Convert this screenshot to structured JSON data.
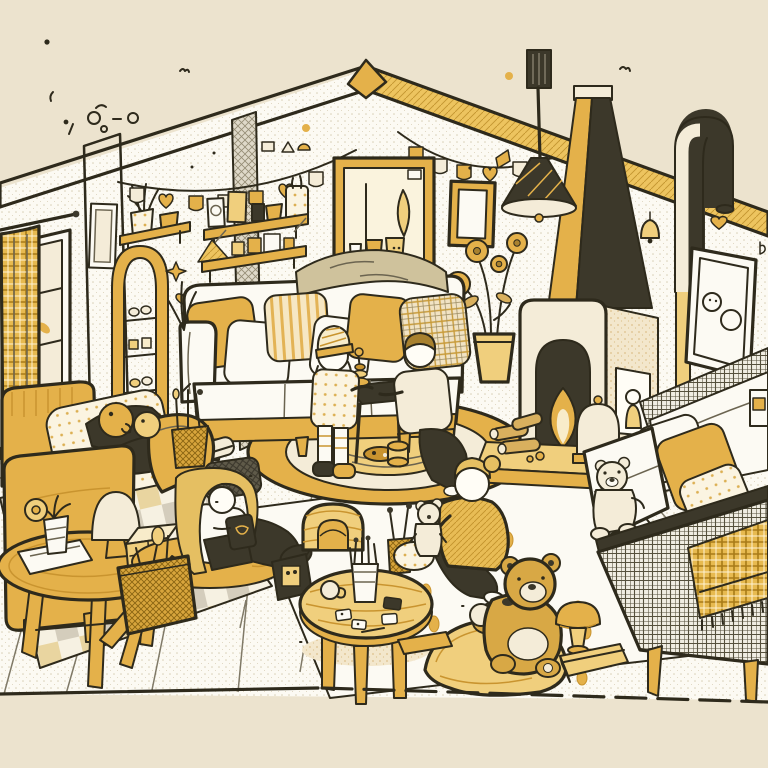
{
  "scene": {
    "description": "Hand-drawn cutaway illustration of a cozy family living room rendered in mustard yellow, cream and black ink line art; gabled back wall, five people, three teddy bears, fireplace with tapered chimney, sofas, rugs and toys.",
    "style": "cartoon line-art, halftone textures, limited mustard/cream palette on beige background",
    "people_count": 5,
    "teddy_bear_count": 3,
    "objects": [
      {
        "id": "roof-fascia",
        "label": "Gabled roof edge with hatched and yellow fascia"
      },
      {
        "id": "bunting-garland-left",
        "label": "Pennant garland on left of back wall"
      },
      {
        "id": "bunting-garland-right",
        "label": "Pennant garland on right of back wall"
      },
      {
        "id": "window",
        "label": "Paned window with yellow plaid curtain"
      },
      {
        "id": "corner-strip",
        "label": "Hatched wall corner strips"
      },
      {
        "id": "small-wall-frame",
        "label": "Small empty frame on left wall"
      },
      {
        "id": "arch-ladder-shelf",
        "label": "Arched ladder shelf with knick-knacks"
      },
      {
        "id": "small-shelf",
        "label": "Small shelf with dried-plant pot and cup"
      },
      {
        "id": "wall-shelves",
        "label": "Two wall shelves with frames, pots and toy blocks"
      },
      {
        "id": "large-wall-art",
        "label": "Large framed botanical artwork with pots"
      },
      {
        "id": "house-wall-art",
        "label": "Small framed house doodle"
      },
      {
        "id": "right-wall-art",
        "label": "Tilted frame with doodle faces and tassel"
      },
      {
        "id": "wall-bell",
        "label": "Small bell on right wall"
      },
      {
        "id": "pendant-lamp",
        "label": "Black cone pendant lamp on rod"
      },
      {
        "id": "fireplace",
        "label": "Fireplace with arched firebox, side niche figurine and tapered chimney"
      },
      {
        "id": "hearth",
        "label": "Hearth platform with logs and pleated dome lantern"
      },
      {
        "id": "chimney-pipe",
        "label": "Curved stove pipe over right wall"
      },
      {
        "id": "flower-pot",
        "label": "Tall potted flowers with round blooms"
      },
      {
        "id": "main-sofa",
        "label": "White sofa with yellow base and five pillows"
      },
      {
        "id": "throw-blanket",
        "label": "Khaki blanket over sofa back"
      },
      {
        "id": "round-rug",
        "label": "Round yellow rug with concentric rings"
      },
      {
        "id": "play-table",
        "label": "Dark play table with stacking-ring toy"
      },
      {
        "id": "child-beanie",
        "label": "Child in striped beanie playing"
      },
      {
        "id": "child-kneeling",
        "label": "Kneeling child in cream sweater"
      },
      {
        "id": "armchair",
        "label": "Yellow armchair with lounging person"
      },
      {
        "id": "ottoman",
        "label": "Dark hatched ottoman"
      },
      {
        "id": "duck-toys",
        "label": "Round duck and smiley toys"
      },
      {
        "id": "pencil-basket",
        "label": "Woven cup with brushes"
      },
      {
        "id": "side-table",
        "label": "Round wooden side table with lamp, plant, paper and toy box"
      },
      {
        "id": "floor-jar",
        "label": "Small jar with dark lid"
      },
      {
        "id": "girl-reading",
        "label": "Long-haired girl reading on a floor cushion"
      },
      {
        "id": "radio-toy",
        "label": "Black toy radio with antenna"
      },
      {
        "id": "barrow-basket",
        "label": "Wheelbarrow basket with utensils"
      },
      {
        "id": "arch-toy",
        "label": "Yellow arch tunnel toy"
      },
      {
        "id": "paint-pot",
        "label": "Pot with paint brushes"
      },
      {
        "id": "coffee-table",
        "label": "Round coffee table with pencil pot, mug and cards"
      },
      {
        "id": "woman-with-teddy",
        "label": "Woman in yellow sweater holding a small teddy"
      },
      {
        "id": "big-teddy",
        "label": "Large teddy bear on yellow lounger cushion"
      },
      {
        "id": "right-sofa",
        "label": "Grey plaid sofa with pillows, white teddy and fringed yellow blanket"
      },
      {
        "id": "mushroom-stool",
        "label": "Yellow mushroom stool"
      },
      {
        "id": "floor-books",
        "label": "Books lying on floor"
      },
      {
        "id": "checker-rug",
        "label": "Checkered rug under armchair"
      },
      {
        "id": "striped-rug",
        "label": "Large striped rug with yellow dots"
      },
      {
        "id": "doodles",
        "label": "Scattered dots, hearts, stars and a fly doodle"
      }
    ]
  },
  "palette": {
    "background": "#ece3ce",
    "paper": "#fcfaf3",
    "cream": "#f4ecd8",
    "ink": "#2e2a1c",
    "inkSoft": "#6b6450",
    "dark": "#3c382a",
    "yellow": "#e4b14a",
    "yellowDeep": "#c9942f",
    "yellowLight": "#f0cf7d",
    "yellowPale": "#f8ecca",
    "tan": "#d9b05e",
    "teddy": "#d8a845",
    "khaki": "#cfc29c",
    "greyLight": "#ddd7c8",
    "greyMid": "#a49c88",
    "hairBlond": "#e5bf62",
    "hairBrown": "#a8812f",
    "face": "#fffdf6"
  }
}
